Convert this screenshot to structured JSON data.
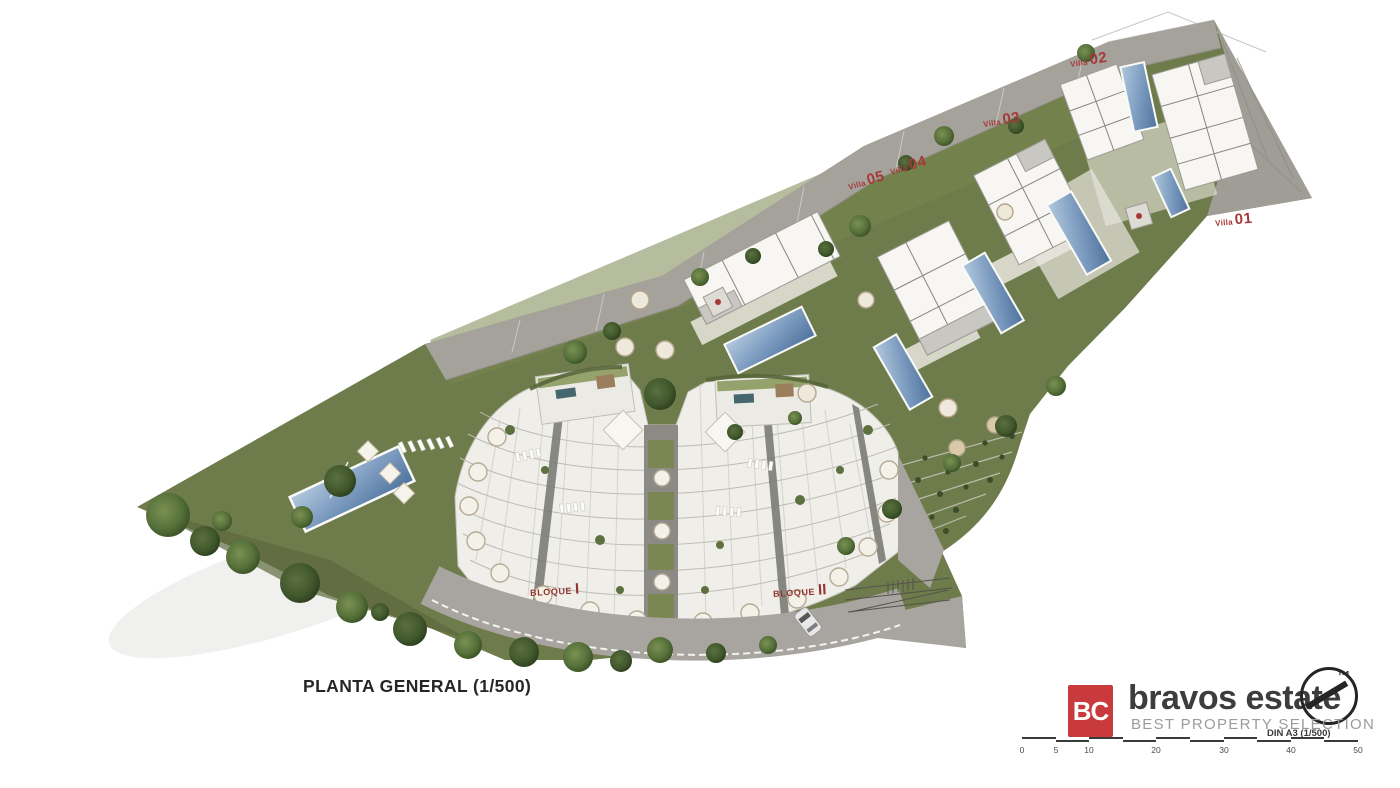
{
  "plan": {
    "title": "PLANTA GENERAL (1/500)"
  },
  "villa_labels": [
    {
      "prefix": "Villa",
      "number": "02"
    },
    {
      "prefix": "Villa",
      "number": "03"
    },
    {
      "prefix": "Villa",
      "number": "04"
    },
    {
      "prefix": "Villa",
      "number": "05"
    },
    {
      "prefix": "Villa",
      "number": "01"
    }
  ],
  "block_labels": [
    {
      "name": "BLOQUE",
      "numeral": "I"
    },
    {
      "name": "BLOQUE",
      "numeral": "II"
    }
  ],
  "branding": {
    "monogram": "BC",
    "name": "bravos estate",
    "trademark": "™",
    "tagline": "BEST PROPERTY SELECTION"
  },
  "scale_bar": {
    "sheet_note": "DIN A3 (1/500)",
    "ticks": [
      "0",
      "5",
      "10",
      "20",
      "30",
      "40",
      "50"
    ]
  },
  "colors": {
    "logo-red": "#c93a3c",
    "label-red": "#a63937",
    "block-red": "#96352f",
    "road-gray": "#a5a29c",
    "garden-green": "#6e7b4a",
    "pool-blue": "#5d80a8",
    "building-white": "#f4f3ee"
  }
}
